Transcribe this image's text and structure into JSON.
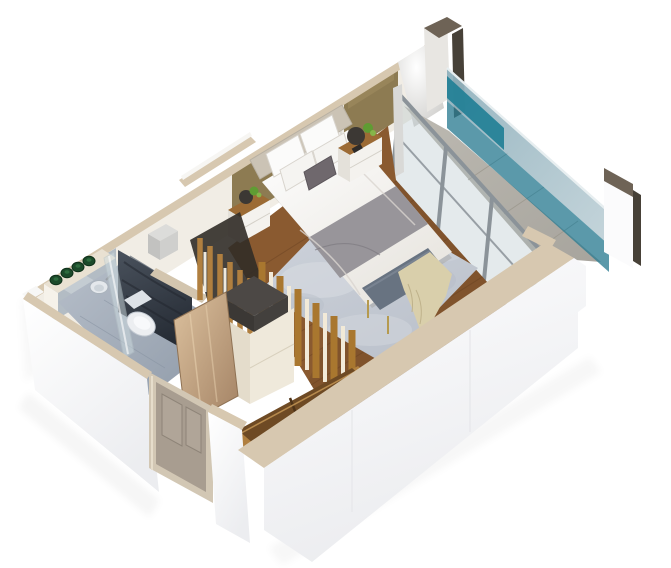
{
  "image": {
    "kind": "isometric-3d-floor-plan-render",
    "width": 671,
    "height": 568,
    "background": "#ffffff"
  },
  "scene": {
    "label": "bedroom-suite-floor-plan",
    "rooms": [
      "bathroom",
      "wardrobe-hall",
      "bedroom",
      "balcony"
    ]
  },
  "palette": {
    "background": "#ffffff",
    "wall_white": "#fdfdfe",
    "wall_shade": "#eef0f3",
    "cap_beige": "#d7c8b0",
    "cap_beige_dark": "#c6b499",
    "interior_wall": "#f1ede5",
    "mirror_gray": "#b3bcc4",
    "pillar_cap": "#6e6356",
    "pillar_dark": "#474138",
    "pillar_face": "#e8e6e2",
    "glass_light": "#9db8c2",
    "glass_teal": "#2d7c92",
    "glass_teal_bright": "#1f7e95",
    "glass_teal_sliver": "#2aa3bb",
    "door_frame_gray": "#8b9399",
    "balcony_floor": "#b5b1aa",
    "wood_floor": "#8a5a30",
    "wood_floor_dark": "#64401f",
    "rug": "#c7ccd4",
    "rug_light": "#d8dce2",
    "bed_white": "#f8f7f5",
    "bed_shadow": "#dedbd5",
    "blanket_gray": "#98959a",
    "pillow_white": "#fbfbfa",
    "pillow_accent": "#6f686d",
    "headboard": "#cbc3b5",
    "bench_blue": "#687381",
    "throw_cream": "#d9cfab",
    "gold": "#b59a4f",
    "brass_panel": "#8d7b52",
    "slat_panel": "#edebe6",
    "nightstand_wood": "#9c6b35",
    "nightstand_white": "#f4f2ee",
    "plant_green": "#5f9c33",
    "plant_dark": "#3c3834",
    "bath_floor": "#a3adb9",
    "slate_wall": "#333a44",
    "toilet_white": "#eceef1",
    "shower_glass": "#cfdde1",
    "counter_beige": "#e9e1d2",
    "towel_green": "#1c4a2a",
    "closet_wood": "#b07f3f",
    "closet_dark": "#312c27",
    "cream_cabinet": "#efe9db",
    "dark_box": "#43403d",
    "tan_panel": "#c8a987",
    "door_taupe": "#a89d90",
    "door_frame_beige": "#d2c7b4",
    "metal_box": "#cfcfcd"
  }
}
